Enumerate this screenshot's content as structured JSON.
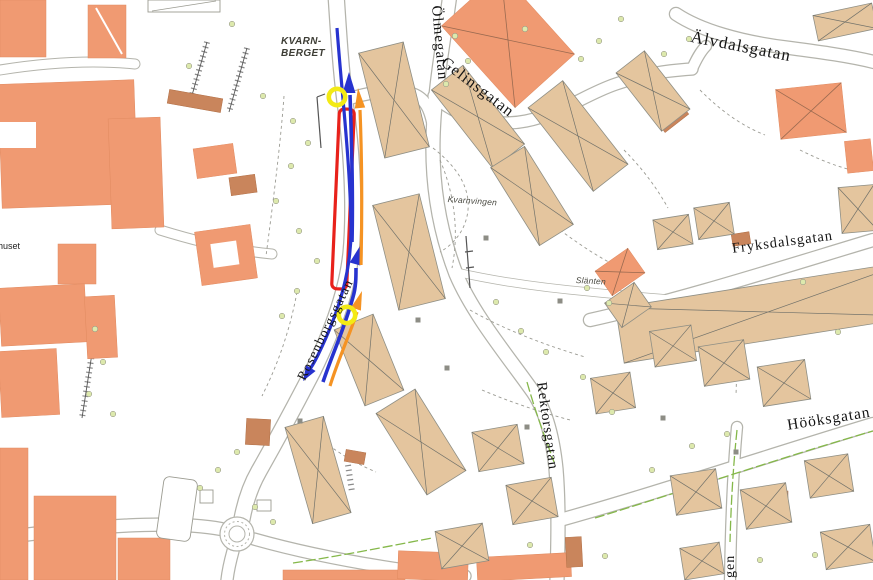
{
  "map": {
    "district_label": {
      "line1": "KVARN-",
      "line2": "BERGET"
    },
    "streets": {
      "olmegatan": "Ölmegatan",
      "gelinsgatan": "Gelinsgatan",
      "alvdalsgatan": "Älvdalsgatan",
      "fryksdalsgatan": "Fryksdalsgatan",
      "hooksgatan": "Hööksgatan",
      "rektorsgatan": "Rektorsgatan",
      "rosenborgsgatan": "Rosenborgsgatan",
      "street_name_fragment": "gen"
    },
    "places": {
      "kvarnvingen": "Kvarnvingen",
      "slanten": "Slänten",
      "building_fragment": "huset"
    },
    "overlay": {
      "route_blue_color": "#2733cf",
      "route_orange_color": "#f59323",
      "closed_road_color": "#e8211b",
      "marker_color": "#f3ea15"
    },
    "base_colors": {
      "large_building": "#f09a72",
      "residential_building": "#e4c59e",
      "small_building": "#c9855c",
      "road_casing": "#b4b4ac",
      "vegetation": "#dde9ad",
      "hedge": "#85b84a"
    }
  }
}
